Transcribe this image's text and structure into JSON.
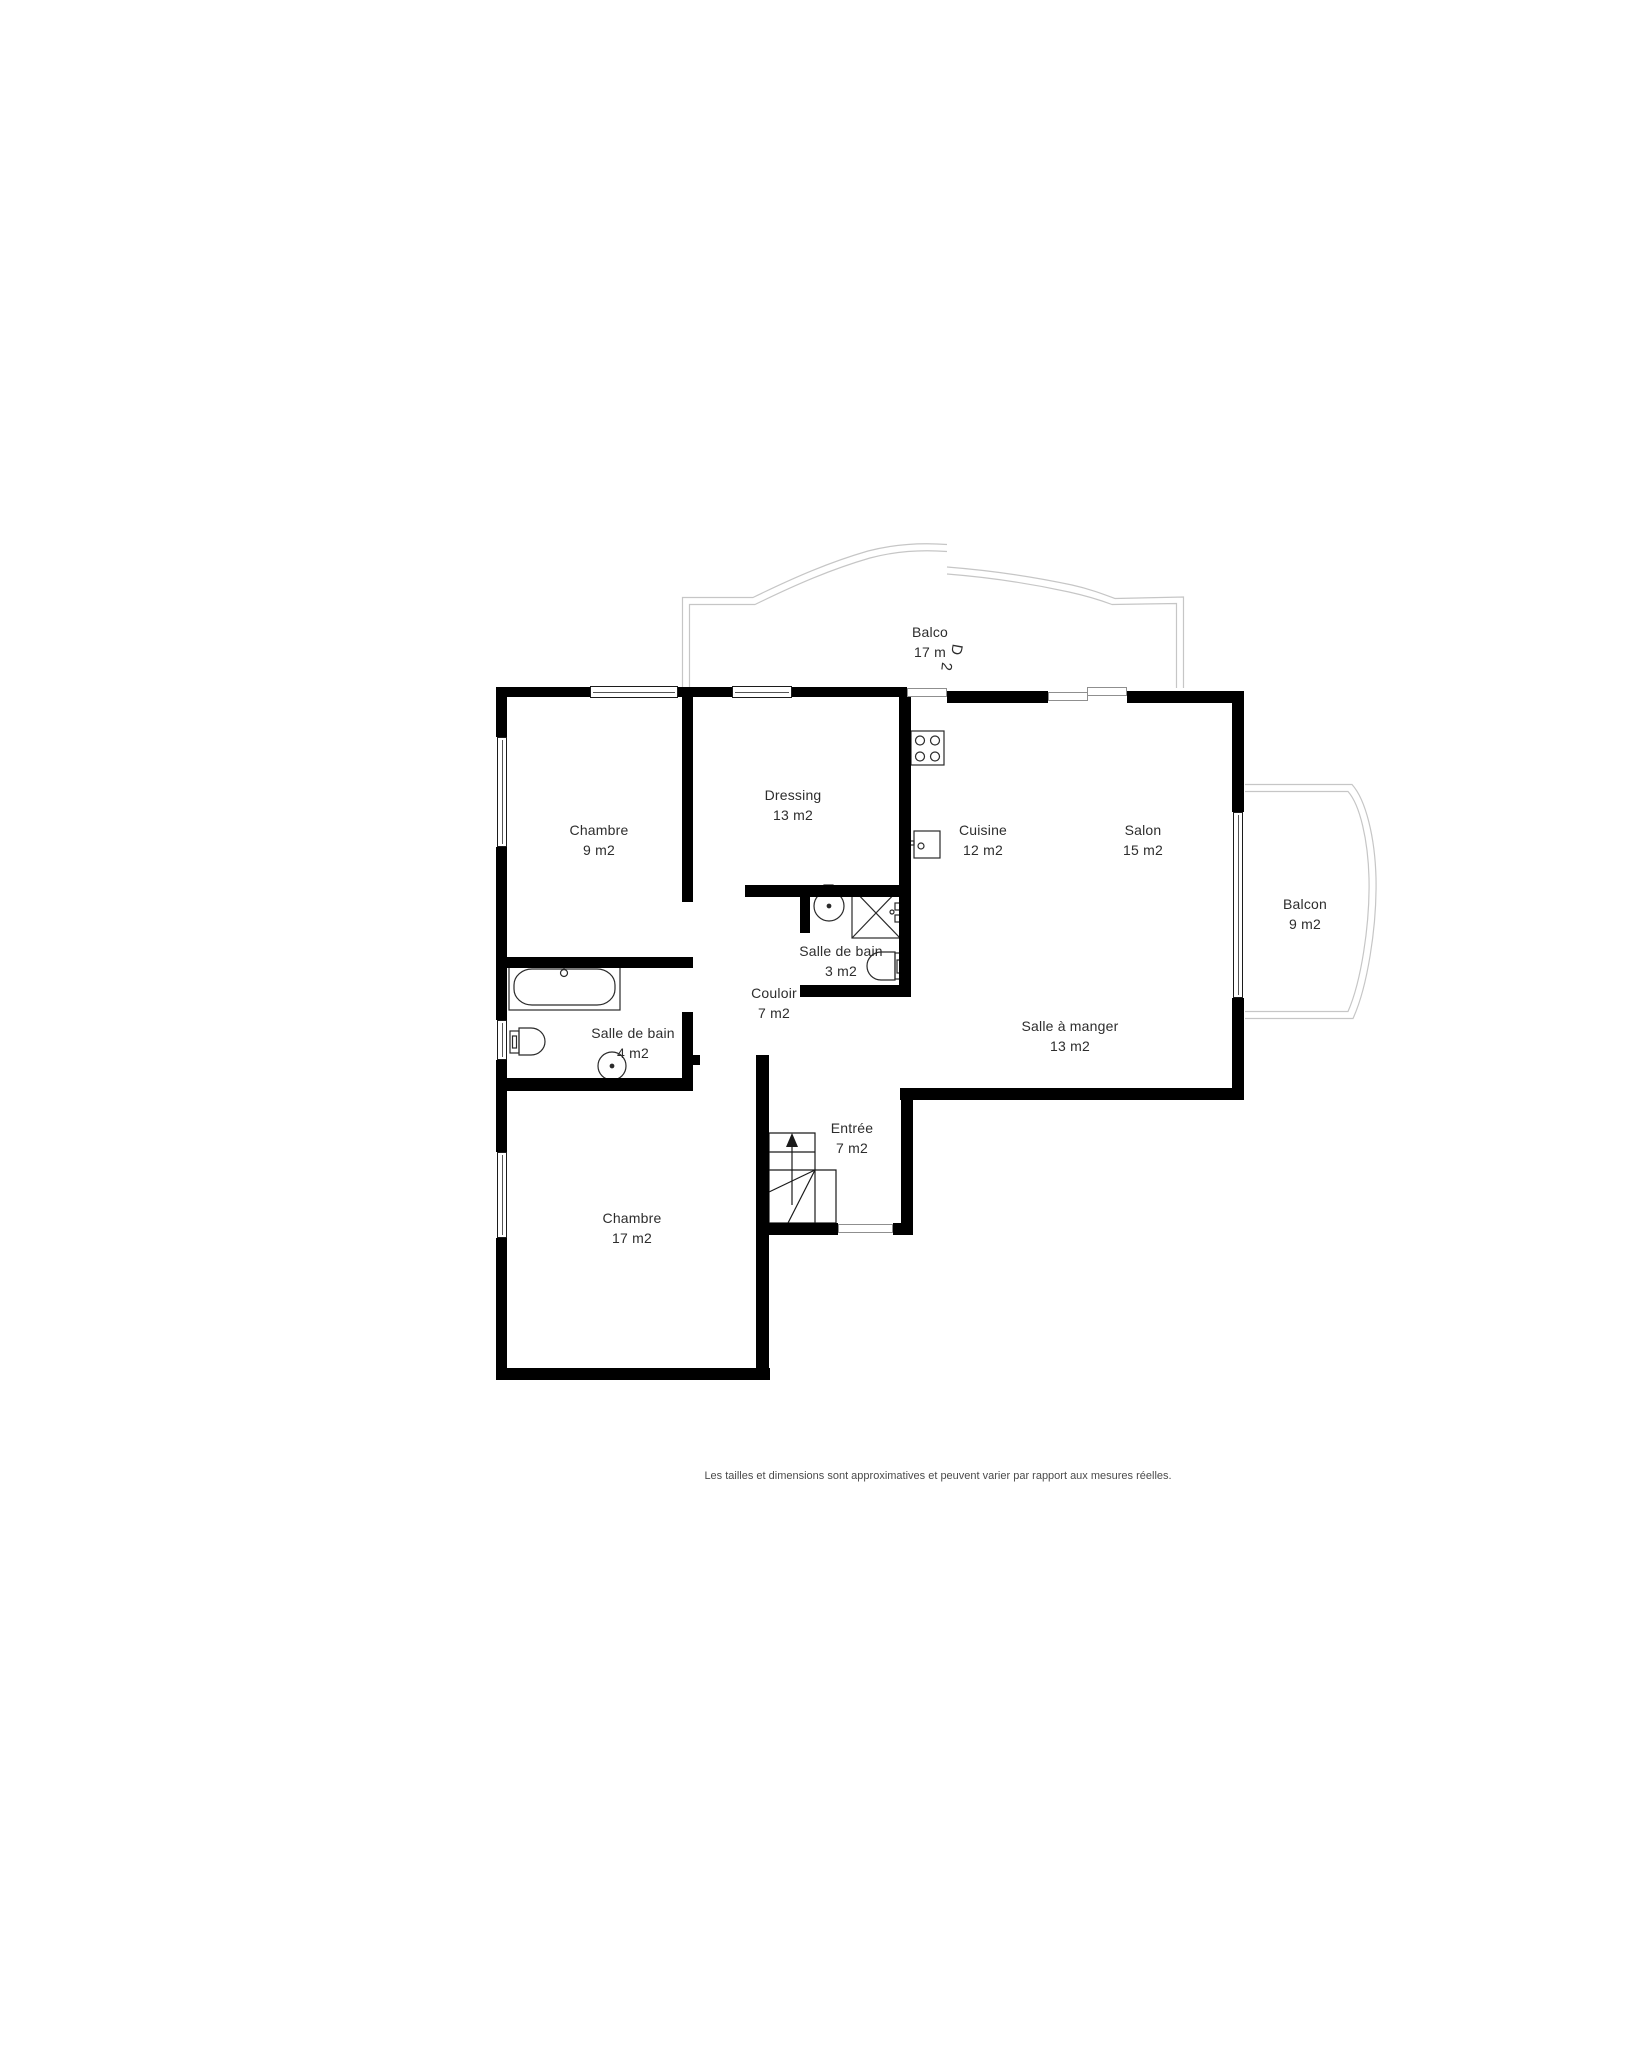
{
  "floor_plan": {
    "rooms": [
      {
        "id": "balcon-nord",
        "name": "Balco",
        "area": "17 m",
        "glitch": [
          "D",
          "2"
        ]
      },
      {
        "id": "chambre-9",
        "name": "Chambre",
        "area": "9 m2"
      },
      {
        "id": "dressing",
        "name": "Dressing",
        "area": "13 m2"
      },
      {
        "id": "cuisine",
        "name": "Cuisine",
        "area": "12 m2"
      },
      {
        "id": "salon",
        "name": "Salon",
        "area": "15 m2"
      },
      {
        "id": "balcon-est",
        "name": "Balcon",
        "area": "9 m2"
      },
      {
        "id": "salle-de-bain-3",
        "name": "Salle de bain",
        "area": "3 m2"
      },
      {
        "id": "couloir",
        "name": "Couloir",
        "area": "7 m2"
      },
      {
        "id": "salle-a-manger",
        "name": "Salle à manger",
        "area": "13 m2"
      },
      {
        "id": "salle-de-bain-4",
        "name": "Salle de bain",
        "area": "4 m2"
      },
      {
        "id": "entree",
        "name": "Entrée",
        "area": "7 m2"
      },
      {
        "id": "chambre-17",
        "name": "Chambre",
        "area": "17 m2"
      }
    ],
    "fixtures": [
      "bathtub",
      "toilet",
      "washbasin",
      "shower",
      "stove",
      "kitchen-sink",
      "staircase",
      "window",
      "door"
    ],
    "colors": {
      "wall": "#000000",
      "balcony-outline": "#c6c6c6",
      "text": "#2d2d2d"
    }
  },
  "footer": {
    "note": "Les tailles et dimensions sont approximatives et peuvent varier par rapport aux mesures réelles."
  }
}
